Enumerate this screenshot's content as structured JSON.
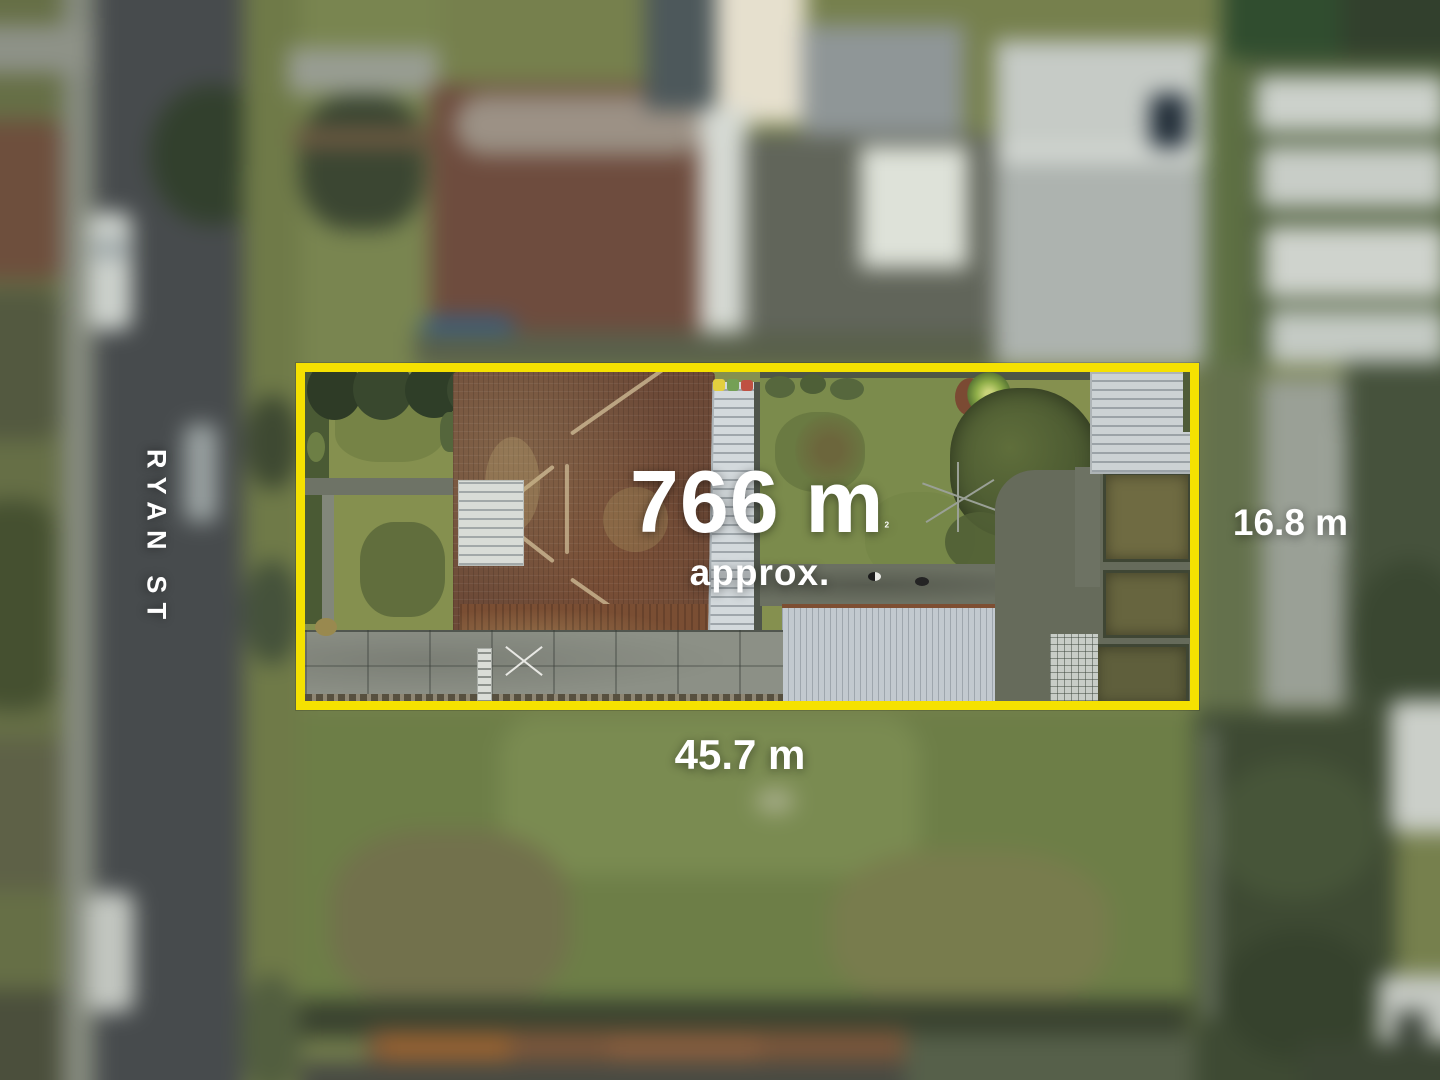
{
  "overlay": {
    "street_label": "RYAN ST",
    "area_value": "766 m",
    "area_superscript": "2",
    "area_qualifier": "approx.",
    "frontage_dimension": "45.7 m",
    "side_dimension": "16.8 m"
  },
  "colors": {
    "boundary_yellow": "#F5E101",
    "overlay_text": "#FFFFFF"
  }
}
